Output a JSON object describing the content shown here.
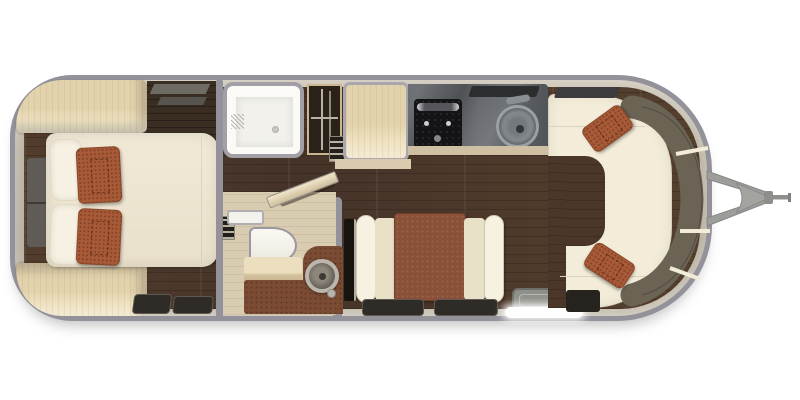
{
  "scene": {
    "kind": "floor-plan",
    "subject": "travel trailer interior, top-down view",
    "background": "#ffffff"
  },
  "palette": {
    "wall": "#93919a",
    "band": "#b9b1a2",
    "wood": "#4a3729",
    "bathfloor": "#d9ccb0",
    "lightwood": "#eadcba",
    "cream": "#f2ecd9",
    "rust": "#a85a37",
    "darkcounter": "#3a2e23",
    "granite": "#5d6165",
    "stove": "#141417",
    "olive": "#6b6455",
    "tablebrown": "#8a5138",
    "vanitybrown": "#7b4b33",
    "fixture": "#fbfaf6",
    "hitch": "#9d9d99"
  },
  "rooms": {
    "bedroom": {
      "label": "bedroom",
      "furniture": {
        "wardrobe_top": "corner wardrobe",
        "wardrobe_bottom": "corner wardrobe",
        "dresser": "dresser with window above",
        "headboard": "headboard",
        "bed": "bed with pillows",
        "pillow_white": "white pillow",
        "pillow_accent": "rust accent pillow",
        "floor_mat": "floor mat"
      }
    },
    "bathroom": {
      "label": "bathroom",
      "furniture": {
        "shower": "shower stall",
        "closet": "hanging wardrobe",
        "toilet": "toilet",
        "shelf": "shelf",
        "bench": "bench step",
        "vanity": "vanity cabinet",
        "sink": "round vessel sink",
        "door": "angled privacy door"
      }
    },
    "kitchen": {
      "label": "galley kitchen",
      "furniture": {
        "pantry": "pantry counter",
        "countertop": "granite countertop",
        "cooktop": "gas cooktop",
        "sink": "round kitchen sink",
        "vent": "window slot",
        "trim": "counter front trim"
      }
    },
    "dinette": {
      "label": "dinette",
      "furniture": {
        "table": "dinette table",
        "bench_left": "bench seat",
        "bench_right": "bench seat",
        "media": "media panel",
        "floor_mat": "floor mat",
        "entry_mat": "entry step mat",
        "entry_glow": "entry door opening"
      }
    },
    "lounge": {
      "label": "front lounge",
      "furniture": {
        "sofa": "wraparound sofa",
        "backrest": "curved backrest cushions",
        "pillow": "rust accent pillow",
        "window": "window slot",
        "mat": "floor mat"
      }
    },
    "exterior": {
      "label": "trailer shell",
      "furniture": {
        "shell": "rounded aluminum shell",
        "floorboards": "walnut plank flooring",
        "hitch": "a-frame tow hitch",
        "coupler": "hitch coupler and jack"
      }
    }
  }
}
